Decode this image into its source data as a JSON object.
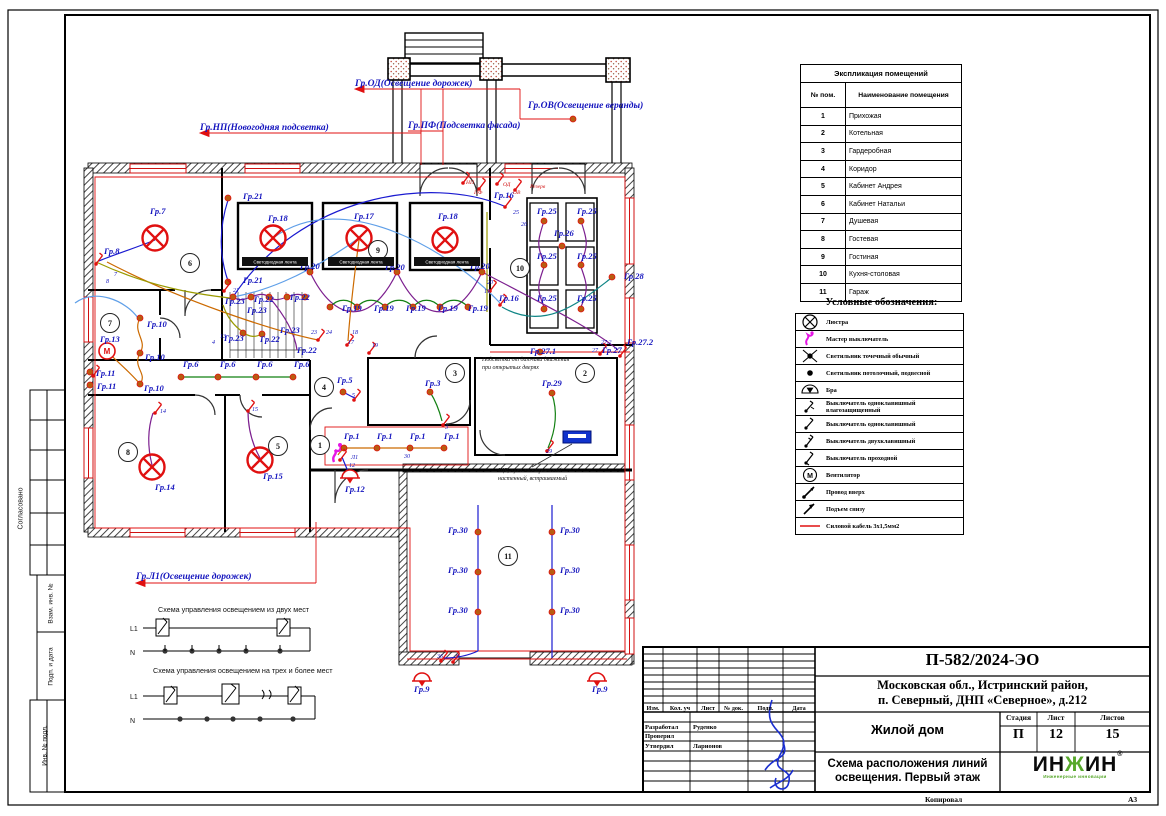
{
  "sheet": {
    "copied_label": "Копировал",
    "format_label": "А3"
  },
  "side_stamps": {
    "approved": "Согласовано",
    "vzam": "Взам. инв. №",
    "podp": "Подп. и дата",
    "inv": "Инв. № подл."
  },
  "feeders": [
    {
      "x": 355,
      "y": 86,
      "text": "Гр.ОД(Освещение дорожек)"
    },
    {
      "x": 528,
      "y": 108,
      "text": "Гр.ОВ(Освещение веранды)"
    },
    {
      "x": 200,
      "y": 130,
      "text": "Гр.НП(Новогодняя подсветка)"
    },
    {
      "x": 408,
      "y": 128,
      "text": "Гр.ПФ(Подсветка фасада)"
    },
    {
      "x": 136,
      "y": 579,
      "text": "Гр.Л1(Освещение дорожек)"
    }
  ],
  "plan": {
    "led_strip_label": "Светодиодная лента",
    "led_bars": [
      {
        "x": 275,
        "y": 264
      },
      {
        "x": 361,
        "y": 264
      },
      {
        "x": 447,
        "y": 264
      }
    ],
    "rooms": [
      {
        "n": "1",
        "x": 320,
        "y": 445
      },
      {
        "n": "2",
        "x": 585,
        "y": 373
      },
      {
        "n": "3",
        "x": 455,
        "y": 373
      },
      {
        "n": "4",
        "x": 324,
        "y": 387
      },
      {
        "n": "5",
        "x": 278,
        "y": 446
      },
      {
        "n": "6",
        "x": 190,
        "y": 263
      },
      {
        "n": "7",
        "x": 110,
        "y": 323
      },
      {
        "n": "8",
        "x": 128,
        "y": 452
      },
      {
        "n": "9",
        "x": 378,
        "y": 250
      },
      {
        "n": "10",
        "x": 520,
        "y": 268
      },
      {
        "n": "11",
        "x": 508,
        "y": 556
      }
    ],
    "labels": [
      {
        "x": 150,
        "y": 214,
        "t": "Гр.7",
        "k": "g"
      },
      {
        "x": 104,
        "y": 254,
        "t": "Гр.8",
        "k": "g"
      },
      {
        "x": 243,
        "y": 199,
        "t": "Гр.21",
        "k": "g"
      },
      {
        "x": 243,
        "y": 283,
        "t": "Гр.21",
        "k": "g"
      },
      {
        "x": 268,
        "y": 221,
        "t": "Гр.18",
        "k": "g"
      },
      {
        "x": 354,
        "y": 219,
        "t": "Гр.17",
        "k": "g"
      },
      {
        "x": 438,
        "y": 219,
        "t": "Гр.18",
        "k": "g"
      },
      {
        "x": 300,
        "y": 269,
        "t": "Гр.20",
        "k": "g"
      },
      {
        "x": 385,
        "y": 270,
        "t": "Гр.20",
        "k": "g"
      },
      {
        "x": 470,
        "y": 269,
        "t": "Гр.20",
        "k": "g"
      },
      {
        "x": 494,
        "y": 198,
        "t": "Гр.16",
        "k": "g"
      },
      {
        "x": 499,
        "y": 301,
        "t": "Гр.16",
        "k": "g"
      },
      {
        "x": 537,
        "y": 214,
        "t": "Гр.25",
        "k": "g"
      },
      {
        "x": 577,
        "y": 214,
        "t": "Гр.25",
        "k": "g"
      },
      {
        "x": 537,
        "y": 259,
        "t": "Гр.25",
        "k": "g"
      },
      {
        "x": 577,
        "y": 259,
        "t": "Гр.25",
        "k": "g"
      },
      {
        "x": 537,
        "y": 301,
        "t": "Гр.25",
        "k": "g"
      },
      {
        "x": 577,
        "y": 301,
        "t": "Гр.25",
        "k": "g"
      },
      {
        "x": 554,
        "y": 236,
        "t": "Гр.26",
        "k": "g"
      },
      {
        "x": 624,
        "y": 279,
        "t": "Гр.28",
        "k": "g"
      },
      {
        "x": 100,
        "y": 342,
        "t": "Гр.13",
        "k": "g"
      },
      {
        "x": 147,
        "y": 327,
        "t": "Гр.10",
        "k": "g"
      },
      {
        "x": 145,
        "y": 360,
        "t": "Гр.10",
        "k": "g"
      },
      {
        "x": 144,
        "y": 391,
        "t": "Гр.10",
        "k": "g"
      },
      {
        "x": 96,
        "y": 376,
        "t": "Гр.11",
        "k": "g"
      },
      {
        "x": 97,
        "y": 389,
        "t": "Гр.11",
        "k": "g"
      },
      {
        "x": 225,
        "y": 304,
        "t": "Гр.23",
        "k": "g"
      },
      {
        "x": 254,
        "y": 302,
        "t": "Гр.22",
        "k": "g"
      },
      {
        "x": 290,
        "y": 300,
        "t": "Гр.22",
        "k": "g"
      },
      {
        "x": 247,
        "y": 313,
        "t": "Гр.23",
        "k": "g"
      },
      {
        "x": 280,
        "y": 333,
        "t": "Гр.23",
        "k": "g"
      },
      {
        "x": 224,
        "y": 341,
        "t": "Гр.23",
        "k": "g"
      },
      {
        "x": 260,
        "y": 342,
        "t": "Гр.22",
        "k": "g"
      },
      {
        "x": 297,
        "y": 353,
        "t": "Гр.22",
        "k": "g"
      },
      {
        "x": 342,
        "y": 311,
        "t": "Гр.19",
        "k": "g"
      },
      {
        "x": 374,
        "y": 311,
        "t": "Гр.19",
        "k": "g"
      },
      {
        "x": 406,
        "y": 311,
        "t": "Гр.19",
        "k": "g"
      },
      {
        "x": 438,
        "y": 311,
        "t": "Гр.19",
        "k": "g"
      },
      {
        "x": 468,
        "y": 311,
        "t": "Гр.19",
        "k": "g"
      },
      {
        "x": 183,
        "y": 367,
        "t": "Гр.6",
        "k": "g"
      },
      {
        "x": 220,
        "y": 367,
        "t": "Гр.6",
        "k": "g"
      },
      {
        "x": 257,
        "y": 367,
        "t": "Гр.6",
        "k": "g"
      },
      {
        "x": 294,
        "y": 367,
        "t": "Гр.6",
        "k": "g"
      },
      {
        "x": 337,
        "y": 383,
        "t": "Гр.5",
        "k": "g"
      },
      {
        "x": 425,
        "y": 386,
        "t": "Гр.3",
        "k": "g"
      },
      {
        "x": 542,
        "y": 386,
        "t": "Гр.29",
        "k": "g"
      },
      {
        "x": 530,
        "y": 354,
        "t": "Гр.27.1",
        "k": "g"
      },
      {
        "x": 602,
        "y": 353,
        "t": "Гр.27",
        "k": "g"
      },
      {
        "x": 627,
        "y": 345,
        "t": "Гр.27.2",
        "k": "g"
      },
      {
        "x": 344,
        "y": 439,
        "t": "Гр.1",
        "k": "g"
      },
      {
        "x": 377,
        "y": 439,
        "t": "Гр.1",
        "k": "g"
      },
      {
        "x": 410,
        "y": 439,
        "t": "Гр.1",
        "k": "g"
      },
      {
        "x": 444,
        "y": 439,
        "t": "Гр.1",
        "k": "g"
      },
      {
        "x": 155,
        "y": 490,
        "t": "Гр.14",
        "k": "g"
      },
      {
        "x": 263,
        "y": 479,
        "t": "Гр.15",
        "k": "g"
      },
      {
        "x": 345,
        "y": 492,
        "t": "Гр.12",
        "k": "g"
      },
      {
        "x": 448,
        "y": 533,
        "t": "Гр.30",
        "k": "g"
      },
      {
        "x": 560,
        "y": 533,
        "t": "Гр.30",
        "k": "g"
      },
      {
        "x": 448,
        "y": 573,
        "t": "Гр.30",
        "k": "g"
      },
      {
        "x": 560,
        "y": 573,
        "t": "Гр.30",
        "k": "g"
      },
      {
        "x": 448,
        "y": 613,
        "t": "Гр.30",
        "k": "g"
      },
      {
        "x": 560,
        "y": 613,
        "t": "Гр.30",
        "k": "g"
      },
      {
        "x": 414,
        "y": 692,
        "t": "Гр.9",
        "k": "g"
      },
      {
        "x": 592,
        "y": 692,
        "t": "Гр.9",
        "k": "g"
      },
      {
        "x": 114,
        "y": 276,
        "t": "7",
        "k": "n"
      },
      {
        "x": 106,
        "y": 283,
        "t": "8",
        "k": "n"
      },
      {
        "x": 311,
        "y": 334,
        "t": "23",
        "k": "n"
      },
      {
        "x": 326,
        "y": 334,
        "t": "24",
        "k": "n"
      },
      {
        "x": 352,
        "y": 334,
        "t": "18",
        "k": "n"
      },
      {
        "x": 348,
        "y": 344,
        "t": "17",
        "k": "n"
      },
      {
        "x": 372,
        "y": 347,
        "t": "19",
        "k": "n"
      },
      {
        "x": 484,
        "y": 293,
        "t": "19",
        "k": "n"
      },
      {
        "x": 487,
        "y": 284,
        "t": "20",
        "k": "n"
      },
      {
        "x": 513,
        "y": 214,
        "t": "25",
        "k": "n"
      },
      {
        "x": 521,
        "y": 226,
        "t": "26",
        "k": "n"
      },
      {
        "x": 546,
        "y": 453,
        "t": "29",
        "k": "n"
      },
      {
        "x": 445,
        "y": 429,
        "t": "3",
        "k": "n"
      },
      {
        "x": 352,
        "y": 397,
        "t": "5",
        "k": "n"
      },
      {
        "x": 404,
        "y": 458,
        "t": "30",
        "k": "n"
      },
      {
        "x": 437,
        "y": 658,
        "t": "36",
        "k": "n"
      },
      {
        "x": 456,
        "y": 658,
        "t": "9",
        "k": "n"
      },
      {
        "x": 160,
        "y": 413,
        "t": "14",
        "k": "n"
      },
      {
        "x": 252,
        "y": 411,
        "t": "15",
        "k": "n"
      },
      {
        "x": 349,
        "y": 467,
        "t": "12",
        "k": "n"
      },
      {
        "x": 351,
        "y": 459,
        "t": "Л1",
        "k": "n"
      },
      {
        "x": 220,
        "y": 338,
        "t": "13",
        "k": "n"
      },
      {
        "x": 212,
        "y": 344,
        "t": "4",
        "k": "n"
      },
      {
        "x": 233,
        "y": 292,
        "t": "21",
        "k": "n"
      },
      {
        "x": 592,
        "y": 352,
        "t": "27",
        "k": "n"
      },
      {
        "x": 601,
        "y": 344,
        "t": "27.2",
        "k": "n"
      },
      {
        "x": 466,
        "y": 184,
        "t": "НП",
        "k": "r"
      },
      {
        "x": 474,
        "y": 194,
        "t": "ПФ",
        "k": "r"
      },
      {
        "x": 503,
        "y": 186,
        "t": "ОД",
        "k": "r"
      },
      {
        "x": 513,
        "y": 194,
        "t": "ОВ",
        "k": "r"
      },
      {
        "x": 530,
        "y": 188,
        "t": "Резерв",
        "k": "r"
      }
    ],
    "notes": [
      {
        "x": 482,
        "y": 361,
        "lines": [
          "Подсветка от датчика движения",
          "при открытых дверях"
        ]
      },
      {
        "x": 498,
        "y": 472,
        "lines": [
          "ЩР, щит электрический",
          "настенный, встраиваемый"
        ]
      }
    ],
    "symbols": [
      {
        "t": "ch",
        "x": 155,
        "y": 238
      },
      {
        "t": "ch",
        "x": 273,
        "y": 238
      },
      {
        "t": "ch",
        "x": 359,
        "y": 238
      },
      {
        "t": "ch",
        "x": 445,
        "y": 240
      },
      {
        "t": "ch",
        "x": 152,
        "y": 467
      },
      {
        "t": "ch",
        "x": 260,
        "y": 460
      },
      {
        "t": "fan",
        "x": 107,
        "y": 351
      },
      {
        "t": "ms",
        "x": 337,
        "y": 455
      },
      {
        "t": "panel",
        "x": 577,
        "y": 437
      },
      {
        "t": "bra",
        "x": 350,
        "y": 478
      },
      {
        "t": "bra",
        "x": 422,
        "y": 681
      },
      {
        "t": "bra",
        "x": 597,
        "y": 681
      },
      {
        "t": "d",
        "x": 330,
        "y": 307
      },
      {
        "t": "d",
        "x": 357,
        "y": 307
      },
      {
        "t": "d",
        "x": 385,
        "y": 307
      },
      {
        "t": "d",
        "x": 413,
        "y": 307
      },
      {
        "t": "d",
        "x": 440,
        "y": 307
      },
      {
        "t": "d",
        "x": 468,
        "y": 307
      },
      {
        "t": "d",
        "x": 310,
        "y": 272
      },
      {
        "t": "d",
        "x": 397,
        "y": 272
      },
      {
        "t": "d",
        "x": 482,
        "y": 272
      },
      {
        "t": "d",
        "x": 233,
        "y": 297
      },
      {
        "t": "d",
        "x": 251,
        "y": 297
      },
      {
        "t": "d",
        "x": 269,
        "y": 297
      },
      {
        "t": "d",
        "x": 287,
        "y": 297
      },
      {
        "t": "d",
        "x": 305,
        "y": 297
      },
      {
        "t": "d",
        "x": 243,
        "y": 333
      },
      {
        "t": "d",
        "x": 262,
        "y": 334
      },
      {
        "t": "d",
        "x": 181,
        "y": 377
      },
      {
        "t": "d",
        "x": 218,
        "y": 377
      },
      {
        "t": "d",
        "x": 256,
        "y": 377
      },
      {
        "t": "d",
        "x": 293,
        "y": 377
      },
      {
        "t": "d",
        "x": 140,
        "y": 318
      },
      {
        "t": "d",
        "x": 140,
        "y": 353
      },
      {
        "t": "d",
        "x": 140,
        "y": 384
      },
      {
        "t": "d",
        "x": 90,
        "y": 372
      },
      {
        "t": "d",
        "x": 90,
        "y": 385
      },
      {
        "t": "d",
        "x": 344,
        "y": 448
      },
      {
        "t": "d",
        "x": 377,
        "y": 448
      },
      {
        "t": "d",
        "x": 410,
        "y": 448
      },
      {
        "t": "d",
        "x": 444,
        "y": 448
      },
      {
        "t": "d",
        "x": 343,
        "y": 392
      },
      {
        "t": "d",
        "x": 430,
        "y": 392
      },
      {
        "t": "d",
        "x": 552,
        "y": 393
      },
      {
        "t": "d",
        "x": 544,
        "y": 221
      },
      {
        "t": "d",
        "x": 581,
        "y": 221
      },
      {
        "t": "d",
        "x": 544,
        "y": 265
      },
      {
        "t": "d",
        "x": 581,
        "y": 265
      },
      {
        "t": "d",
        "x": 544,
        "y": 309
      },
      {
        "t": "d",
        "x": 581,
        "y": 309
      },
      {
        "t": "d",
        "x": 562,
        "y": 246
      },
      {
        "t": "d",
        "x": 612,
        "y": 277
      },
      {
        "t": "d",
        "x": 478,
        "y": 532
      },
      {
        "t": "d",
        "x": 552,
        "y": 532
      },
      {
        "t": "d",
        "x": 478,
        "y": 572
      },
      {
        "t": "d",
        "x": 552,
        "y": 572
      },
      {
        "t": "d",
        "x": 478,
        "y": 612
      },
      {
        "t": "d",
        "x": 552,
        "y": 612
      },
      {
        "t": "d",
        "x": 573,
        "y": 119
      },
      {
        "t": "d",
        "x": 540,
        "y": 352
      },
      {
        "t": "d",
        "x": 228,
        "y": 198
      },
      {
        "t": "d",
        "x": 228,
        "y": 282
      },
      {
        "t": "sw",
        "x": 96,
        "y": 264
      },
      {
        "t": "sw",
        "x": 224,
        "y": 291
      },
      {
        "t": "sw",
        "x": 318,
        "y": 340
      },
      {
        "t": "sw",
        "x": 347,
        "y": 345
      },
      {
        "t": "sw",
        "x": 369,
        "y": 353
      },
      {
        "t": "sw",
        "x": 463,
        "y": 183
      },
      {
        "t": "sw",
        "x": 479,
        "y": 189
      },
      {
        "t": "sw",
        "x": 497,
        "y": 184
      },
      {
        "t": "sw",
        "x": 515,
        "y": 190
      },
      {
        "t": "sw",
        "x": 505,
        "y": 207
      },
      {
        "t": "sw",
        "x": 500,
        "y": 305
      },
      {
        "t": "sw",
        "x": 490,
        "y": 291
      },
      {
        "t": "sw",
        "x": 354,
        "y": 400
      },
      {
        "t": "sw",
        "x": 443,
        "y": 425
      },
      {
        "t": "sw",
        "x": 547,
        "y": 451
      },
      {
        "t": "sw",
        "x": 441,
        "y": 661
      },
      {
        "t": "sw",
        "x": 453,
        "y": 662
      },
      {
        "t": "sw",
        "x": 600,
        "y": 354
      },
      {
        "t": "sw",
        "x": 620,
        "y": 356
      },
      {
        "t": "sw",
        "x": 155,
        "y": 413
      },
      {
        "t": "sw",
        "x": 248,
        "y": 411
      },
      {
        "t": "sw",
        "x": 93,
        "y": 376
      },
      {
        "t": "sw",
        "x": 340,
        "y": 460
      }
    ]
  },
  "schemes": {
    "one_title": "Схема управления освещением из двух мест",
    "two_title": "Схема управления освещением на трех и более мест",
    "l1": "L1",
    "n": "N"
  },
  "explication": {
    "title": "Экспликация помещений",
    "col_num": "№ пом.",
    "col_name": "Наименование помещения",
    "rows": [
      [
        "1",
        "Прихожая"
      ],
      [
        "2",
        "Котельная"
      ],
      [
        "3",
        "Гардеробная"
      ],
      [
        "4",
        "Коридор"
      ],
      [
        "5",
        "Кабинет Андрея"
      ],
      [
        "6",
        "Кабинет Натальи"
      ],
      [
        "7",
        "Душевая"
      ],
      [
        "8",
        "Гостевая"
      ],
      [
        "9",
        "Гостиная"
      ],
      [
        "10",
        "Кухня-столовая"
      ],
      [
        "11",
        "Гараж"
      ]
    ]
  },
  "legend": {
    "title": "Условные обозначения:",
    "items": [
      {
        "icon": "chandelier-icon",
        "label": "Люстра"
      },
      {
        "icon": "master-switch-icon",
        "label": "Мастер выключатель"
      },
      {
        "icon": "spot-light-icon",
        "label": "Светильник точечный обычный"
      },
      {
        "icon": "pendant-light-icon",
        "label": "Светильник потолочный, подвесной"
      },
      {
        "icon": "sconce-icon",
        "label": "Бра"
      },
      {
        "icon": "switch-1gang-wp-icon",
        "label": "Выключатель одноклавишный влагозащищенный"
      },
      {
        "icon": "switch-1gang-icon",
        "label": "Выключатель одноклавишный"
      },
      {
        "icon": "switch-2gang-icon",
        "label": "Выключатель двухклавишный"
      },
      {
        "icon": "switch-pass-icon",
        "label": "Выключатель проходной"
      },
      {
        "icon": "fan-icon",
        "label": "Вентилятор"
      },
      {
        "icon": "wire-up-icon",
        "label": "Провод вверх"
      },
      {
        "icon": "rise-from-below-icon",
        "label": "Подъем снизу"
      },
      {
        "icon": "power-cable-icon",
        "label": "Силовой кабель 3х1,5мм2"
      }
    ],
    "accent_red": "#e01010",
    "accent_magenta": "#e515e5"
  },
  "titleblock": {
    "doc_number": "П-582/2024-ЭО",
    "address_line1": "Московская обл., Истринский район,",
    "address_line2": "п. Северный, ДНП «Северное», д.212",
    "object_name": "Жилой дом",
    "stage_label": "Стадия",
    "sheet_label": "Лист",
    "sheets_label": "Листов",
    "stage": "П",
    "sheet": "12",
    "sheets": "15",
    "drawing_title_line1": "Схема расположения линий",
    "drawing_title_line2": "освещения. Первый этаж",
    "columns": [
      "Изм.",
      "Кол. уч",
      "Лист",
      "№ док.",
      "Подп.",
      "Дата"
    ],
    "roles": [
      {
        "role": "Разработал",
        "name": "Руденко"
      },
      {
        "role": "Проверил",
        "name": ""
      },
      {
        "role": "Утвердил",
        "name": "Ларионов"
      }
    ],
    "logo_text": "ИНЖИН",
    "logo_r": "®",
    "logo_sub": "Инженерные инновации",
    "logo_green": "#57a82b"
  }
}
